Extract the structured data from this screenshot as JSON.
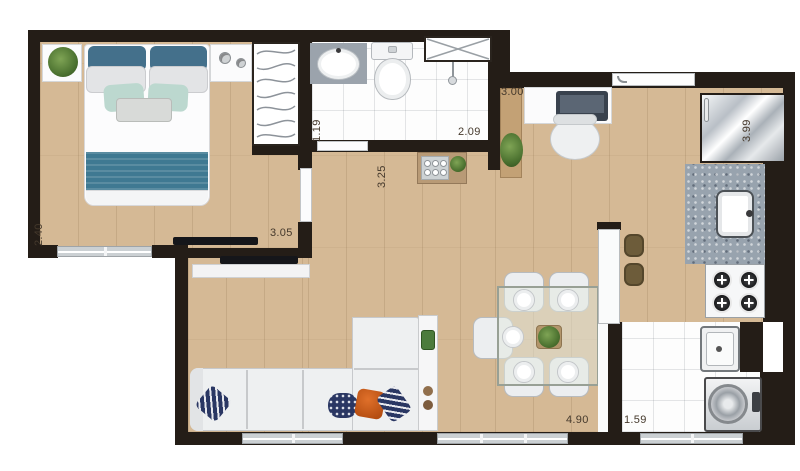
{
  "dimensions": {
    "bedroom": {
      "depth": "2.40",
      "width": "3.05"
    },
    "bathroom": {
      "depth": "1.19",
      "width": "2.09"
    },
    "living_dining": {
      "depth": "3.25",
      "width": "4.90"
    },
    "kitchen": {
      "entry_width": "3.00",
      "side_depth": "3.99"
    },
    "service_area": {
      "width": "1.59"
    }
  },
  "colors": {
    "wall": "#241d17",
    "wood_floor": "#d5b995",
    "tile_floor": "#fdfdfd",
    "granite_counter": "#98a3ae",
    "bed_accent_teal": "#3f7992",
    "pillow_mint": "#bcd8cf",
    "pillow_navy": "#2a3763",
    "pillow_orange": "#d2611e",
    "sofa": "#eef0f1",
    "plant_green": "#4c7230"
  },
  "furniture_icons": [
    "double-bed",
    "wardrobe-hangers",
    "plant",
    "washbasin-vanity",
    "toilet",
    "shower-box",
    "desk-with-laptop",
    "office-chair",
    "refrigerator",
    "kitchen-sink",
    "granite-counter",
    "cooktop-4-burners",
    "laundry-tank",
    "washing-machine",
    "dining-table",
    "dining-chair",
    "l-shaped-sofa",
    "tv-panel",
    "bar-counter",
    "bar-stool",
    "side-console",
    "entry-door",
    "window"
  ]
}
